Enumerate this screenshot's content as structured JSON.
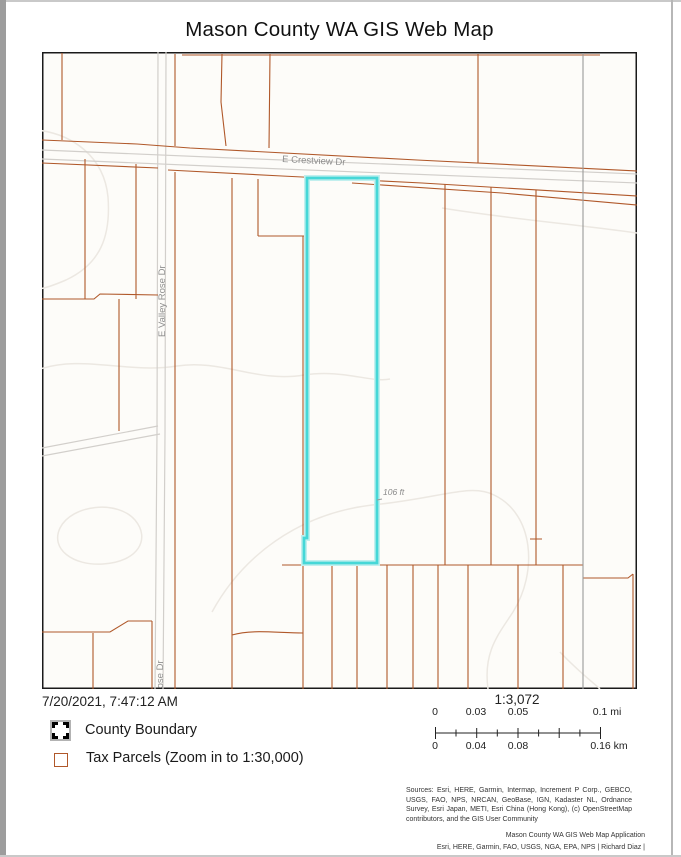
{
  "page": {
    "title": "Mason County WA GIS Web Map"
  },
  "map": {
    "labels": {
      "street_crestview": "E Crestview Dr",
      "street_valley_rose": "E Valley Rose Dr",
      "street_valley_rose_bottom": "E Valley Rose Dr",
      "measurement": "106 ft"
    },
    "colors": {
      "parcel_line": "#b0582a",
      "highlight_parcel": "#46d7d7",
      "road_casing": "#d2cfcb",
      "boundary_gray": "#9a9a98",
      "contour": "#ece8e2"
    }
  },
  "footer": {
    "timestamp": "7/20/2021, 7:47:12 AM",
    "scale_ratio": "1:3,072",
    "legend": [
      {
        "icon": "county-boundary-swatch",
        "label": "County Boundary"
      },
      {
        "icon": "tax-parcels-swatch",
        "label": "Tax Parcels (Zoom in to 1:30,000)"
      }
    ],
    "scalebar": {
      "mi": [
        "0",
        "0.03",
        "0.05",
        "0.1 mi"
      ],
      "km": [
        "0",
        "0.04",
        "0.08",
        "0.16 km"
      ]
    },
    "sources": "Sources: Esri, HERE, Garmin, Intermap, Increment P Corp., GEBCO, USGS, FAO, NPS, NRCAN, GeoBase, IGN, Kadaster NL, Ordnance Survey, Esri Japan, METI, Esri China (Hong Kong), (c) OpenStreetMap contributors, and the GIS User Community",
    "credits": [
      "Mason County WA GIS Web Map Application",
      "Esri, HERE, Garmin, FAO, USGS, NGA, EPA, NPS | Richard Diaz |"
    ]
  }
}
